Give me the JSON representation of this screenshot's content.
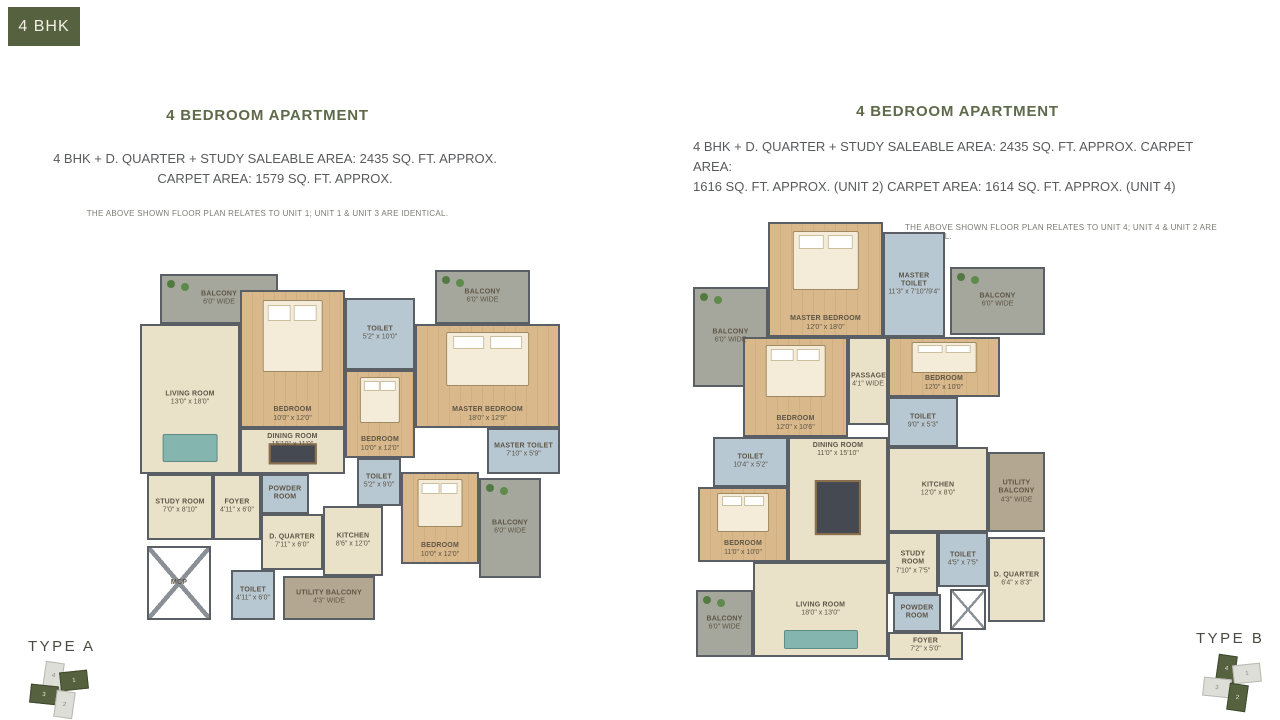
{
  "colors": {
    "accent": "#566140",
    "heading": "#5e6a4a",
    "wall": "#5a5f66"
  },
  "tag": {
    "label": "4 BHK"
  },
  "left_section": {
    "heading": "4 BEDROOM APARTMENT",
    "area_line1": "4 BHK + D. QUARTER + STUDY SALEABLE AREA: 2435 SQ. FT. APPROX.",
    "area_line2": "CARPET AREA: 1579 SQ. FT. APPROX.",
    "note": "THE ABOVE SHOWN FLOOR PLAN RELATES TO UNIT 1; UNIT 1 & UNIT 3 ARE IDENTICAL.",
    "type_label": "TYPE A"
  },
  "right_section": {
    "heading": "4 BEDROOM APARTMENT",
    "area_line1": "4 BHK + D. QUARTER + STUDY SALEABLE AREA: 2435 SQ. FT. APPROX. CARPET AREA:",
    "area_line2": "1616 SQ. FT. APPROX. (UNIT 2) CARPET AREA: 1614 SQ. FT. APPROX. (UNIT 4)",
    "note": "THE ABOVE SHOWN FLOOR PLAN RELATES TO UNIT 4; UNIT 4 & UNIT 2 ARE IDENTICAL.",
    "type_label": "TYPE B"
  },
  "plans": [
    {
      "id": "A",
      "rooms": [
        {
          "name": "BALCONY",
          "dims": "6'0\" WIDE",
          "x": 25,
          "y": 6,
          "w": 118,
          "h": 50,
          "fill": "balcony"
        },
        {
          "name": "LIVING ROOM",
          "dims": "13'0\" x 18'0\"",
          "x": 5,
          "y": 56,
          "w": 100,
          "h": 150,
          "fill": "tan",
          "furn": "sofa"
        },
        {
          "name": "BEDROOM",
          "dims": "10'0\" x 12'0\"",
          "x": 105,
          "y": 22,
          "w": 105,
          "h": 138,
          "fill": "wood",
          "furn": "bed"
        },
        {
          "name": "TOILET",
          "dims": "5'2\" x 10'0\"",
          "x": 210,
          "y": 30,
          "w": 70,
          "h": 72,
          "fill": "toilet"
        },
        {
          "name": "BALCONY",
          "dims": "6'0\" WIDE",
          "x": 300,
          "y": 2,
          "w": 95,
          "h": 54,
          "fill": "balcony"
        },
        {
          "name": "MASTER BEDROOM",
          "dims": "18'0\" x 12'9\"",
          "x": 280,
          "y": 56,
          "w": 145,
          "h": 104,
          "fill": "wood",
          "furn": "bed"
        },
        {
          "name": "BEDROOM",
          "dims": "10'0\" x 12'0\"",
          "x": 210,
          "y": 102,
          "w": 70,
          "h": 88,
          "fill": "wood",
          "furn": "bed"
        },
        {
          "name": "DINING ROOM",
          "dims": "15'10\" x 11'0\"",
          "x": 105,
          "y": 160,
          "w": 105,
          "h": 46,
          "fill": "tan",
          "furn": "table"
        },
        {
          "name": "MASTER TOILET",
          "dims": "7'10\" x 5'9\"",
          "x": 352,
          "y": 160,
          "w": 73,
          "h": 46,
          "fill": "toilet"
        },
        {
          "name": "TOILET",
          "dims": "5'2\" x 9'0\"",
          "x": 222,
          "y": 190,
          "w": 44,
          "h": 48,
          "fill": "toilet"
        },
        {
          "name": "BEDROOM",
          "dims": "10'0\" x 12'0\"",
          "x": 266,
          "y": 204,
          "w": 78,
          "h": 92,
          "fill": "wood",
          "furn": "bed"
        },
        {
          "name": "BALCONY",
          "dims": "6'0\" WIDE",
          "x": 344,
          "y": 210,
          "w": 62,
          "h": 100,
          "fill": "balcony"
        },
        {
          "name": "STUDY ROOM",
          "dims": "7'0\" x 8'10\"",
          "x": 12,
          "y": 206,
          "w": 66,
          "h": 66,
          "fill": "tan"
        },
        {
          "name": "FOYER",
          "dims": "4'11\" x 6'0\"",
          "x": 78,
          "y": 206,
          "w": 48,
          "h": 66,
          "fill": "tan"
        },
        {
          "name": "POWDER ROOM",
          "dims": "",
          "x": 126,
          "y": 206,
          "w": 48,
          "h": 40,
          "fill": "toilet"
        },
        {
          "name": "D. QUARTER",
          "dims": "7'11\" x 6'0\"",
          "x": 126,
          "y": 246,
          "w": 62,
          "h": 56,
          "fill": "tan"
        },
        {
          "name": "KITCHEN",
          "dims": "8'6\" x 12'0\"",
          "x": 188,
          "y": 238,
          "w": 60,
          "h": 70,
          "fill": "tan"
        },
        {
          "name": "MCP",
          "dims": "",
          "x": 12,
          "y": 278,
          "w": 64,
          "h": 74,
          "fill": "shaft"
        },
        {
          "name": "TOILET",
          "dims": "4'11\" x 6'0\"",
          "x": 96,
          "y": 302,
          "w": 44,
          "h": 50,
          "fill": "toilet"
        },
        {
          "name": "UTILITY BALCONY",
          "dims": "4'3\" WIDE",
          "x": 148,
          "y": 308,
          "w": 92,
          "h": 44,
          "fill": "utility"
        }
      ]
    },
    {
      "id": "B",
      "rooms": [
        {
          "name": "BALCONY",
          "dims": "6'0\" WIDE",
          "x": 5,
          "y": 75,
          "w": 75,
          "h": 100,
          "fill": "balcony"
        },
        {
          "name": "MASTER BEDROOM",
          "dims": "12'0\" x 18'0\"",
          "x": 80,
          "y": 10,
          "w": 115,
          "h": 115,
          "fill": "wood",
          "furn": "bed"
        },
        {
          "name": "MASTER TOILET",
          "dims": "11'3\" x 7'10\"/9'4\"",
          "x": 195,
          "y": 20,
          "w": 62,
          "h": 105,
          "fill": "toilet"
        },
        {
          "name": "BALCONY",
          "dims": "6'0\" WIDE",
          "x": 262,
          "y": 55,
          "w": 95,
          "h": 68,
          "fill": "balcony"
        },
        {
          "name": "BEDROOM",
          "dims": "12'0\" x 10'0\"",
          "x": 200,
          "y": 125,
          "w": 112,
          "h": 60,
          "fill": "wood",
          "furn": "bed"
        },
        {
          "name": "PASSAGE",
          "dims": "4'1\" WIDE",
          "x": 160,
          "y": 125,
          "w": 40,
          "h": 88,
          "fill": "tan"
        },
        {
          "name": "BEDROOM",
          "dims": "12'0\" x 10'6\"",
          "x": 55,
          "y": 125,
          "w": 105,
          "h": 100,
          "fill": "wood",
          "furn": "bed"
        },
        {
          "name": "TOILET",
          "dims": "9'0\" x 5'3\"",
          "x": 200,
          "y": 185,
          "w": 70,
          "h": 50,
          "fill": "toilet"
        },
        {
          "name": "TOILET",
          "dims": "10'4\" x 5'2\"",
          "x": 25,
          "y": 225,
          "w": 75,
          "h": 50,
          "fill": "toilet"
        },
        {
          "name": "BEDROOM",
          "dims": "11'0\" x 10'0\"",
          "x": 10,
          "y": 275,
          "w": 90,
          "h": 75,
          "fill": "wood",
          "furn": "bed"
        },
        {
          "name": "DINING ROOM",
          "dims": "11'0\" x 15'10\"",
          "x": 100,
          "y": 225,
          "w": 100,
          "h": 125,
          "fill": "tan",
          "furn": "table"
        },
        {
          "name": "KITCHEN",
          "dims": "12'0\" x 8'0\"",
          "x": 200,
          "y": 235,
          "w": 100,
          "h": 85,
          "fill": "tan"
        },
        {
          "name": "UTILITY BALCONY",
          "dims": "4'3\" WIDE",
          "x": 300,
          "y": 240,
          "w": 57,
          "h": 80,
          "fill": "utility"
        },
        {
          "name": "TOILET",
          "dims": "4'5\" x 7'5\"",
          "x": 250,
          "y": 320,
          "w": 50,
          "h": 55,
          "fill": "toilet"
        },
        {
          "name": "D. QUARTER",
          "dims": "6'4\" x 8'3\"",
          "x": 300,
          "y": 325,
          "w": 57,
          "h": 85,
          "fill": "tan"
        },
        {
          "name": "STUDY ROOM",
          "dims": "7'10\" x 7'5\"",
          "x": 200,
          "y": 320,
          "w": 50,
          "h": 62,
          "fill": "tan"
        },
        {
          "name": "POWDER ROOM",
          "dims": "",
          "x": 205,
          "y": 382,
          "w": 48,
          "h": 38,
          "fill": "toilet"
        },
        {
          "name": "LIVING ROOM",
          "dims": "18'0\" x 13'0\"",
          "x": 65,
          "y": 350,
          "w": 135,
          "h": 95,
          "fill": "tan",
          "furn": "sofa"
        },
        {
          "name": "BALCONY",
          "dims": "6'0\" WIDE",
          "x": 8,
          "y": 378,
          "w": 57,
          "h": 67,
          "fill": "balcony"
        },
        {
          "name": "FOYER",
          "dims": "7'2\" x 5'0\"",
          "x": 200,
          "y": 420,
          "w": 75,
          "h": 28,
          "fill": "tan"
        },
        {
          "name": "",
          "dims": "",
          "x": 262,
          "y": 377,
          "w": 36,
          "h": 41,
          "fill": "shaft"
        }
      ]
    }
  ],
  "keyplans": [
    {
      "label": "TYPE A",
      "units": [
        {
          "num": "4",
          "highlighted": false
        },
        {
          "num": "1",
          "highlighted": true
        },
        {
          "num": "3",
          "highlighted": true
        },
        {
          "num": "2",
          "highlighted": false
        }
      ]
    },
    {
      "label": "TYPE B",
      "units": [
        {
          "num": "4",
          "highlighted": true
        },
        {
          "num": "1",
          "highlighted": false
        },
        {
          "num": "3",
          "highlighted": false
        },
        {
          "num": "2",
          "highlighted": true
        }
      ]
    }
  ]
}
